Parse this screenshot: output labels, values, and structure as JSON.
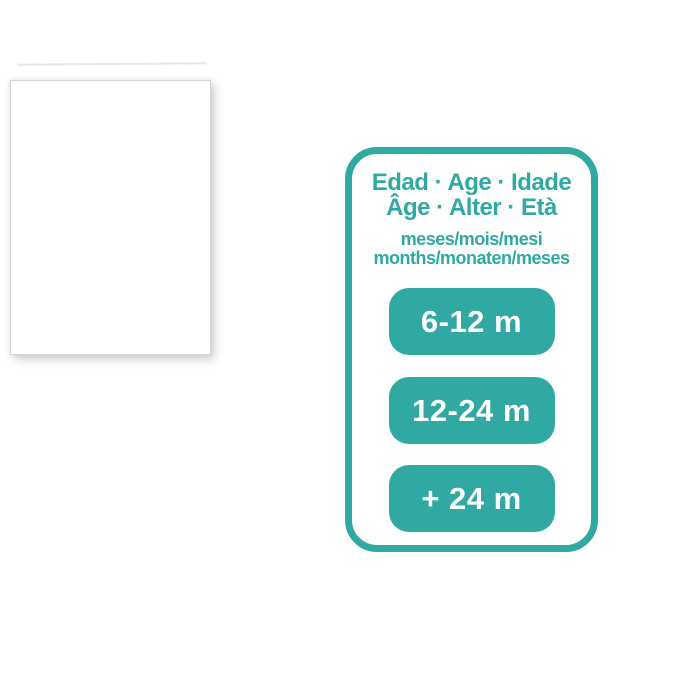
{
  "colors": {
    "teal": "#2FA9A1",
    "background": "#ffffff",
    "badge_text": "#ffffff",
    "page_border": "#d6d6d6"
  },
  "card": {
    "title_line1": "Edad · Age · Idade",
    "title_line2": "Âge · Alter · Età",
    "subtitle_line1": "meses/mois/mesi",
    "subtitle_line2": "months/monaten/meses",
    "age_badges": [
      {
        "label": "6-12 m"
      },
      {
        "label": "12-24 m"
      },
      {
        "label": "+ 24 m"
      }
    ]
  }
}
